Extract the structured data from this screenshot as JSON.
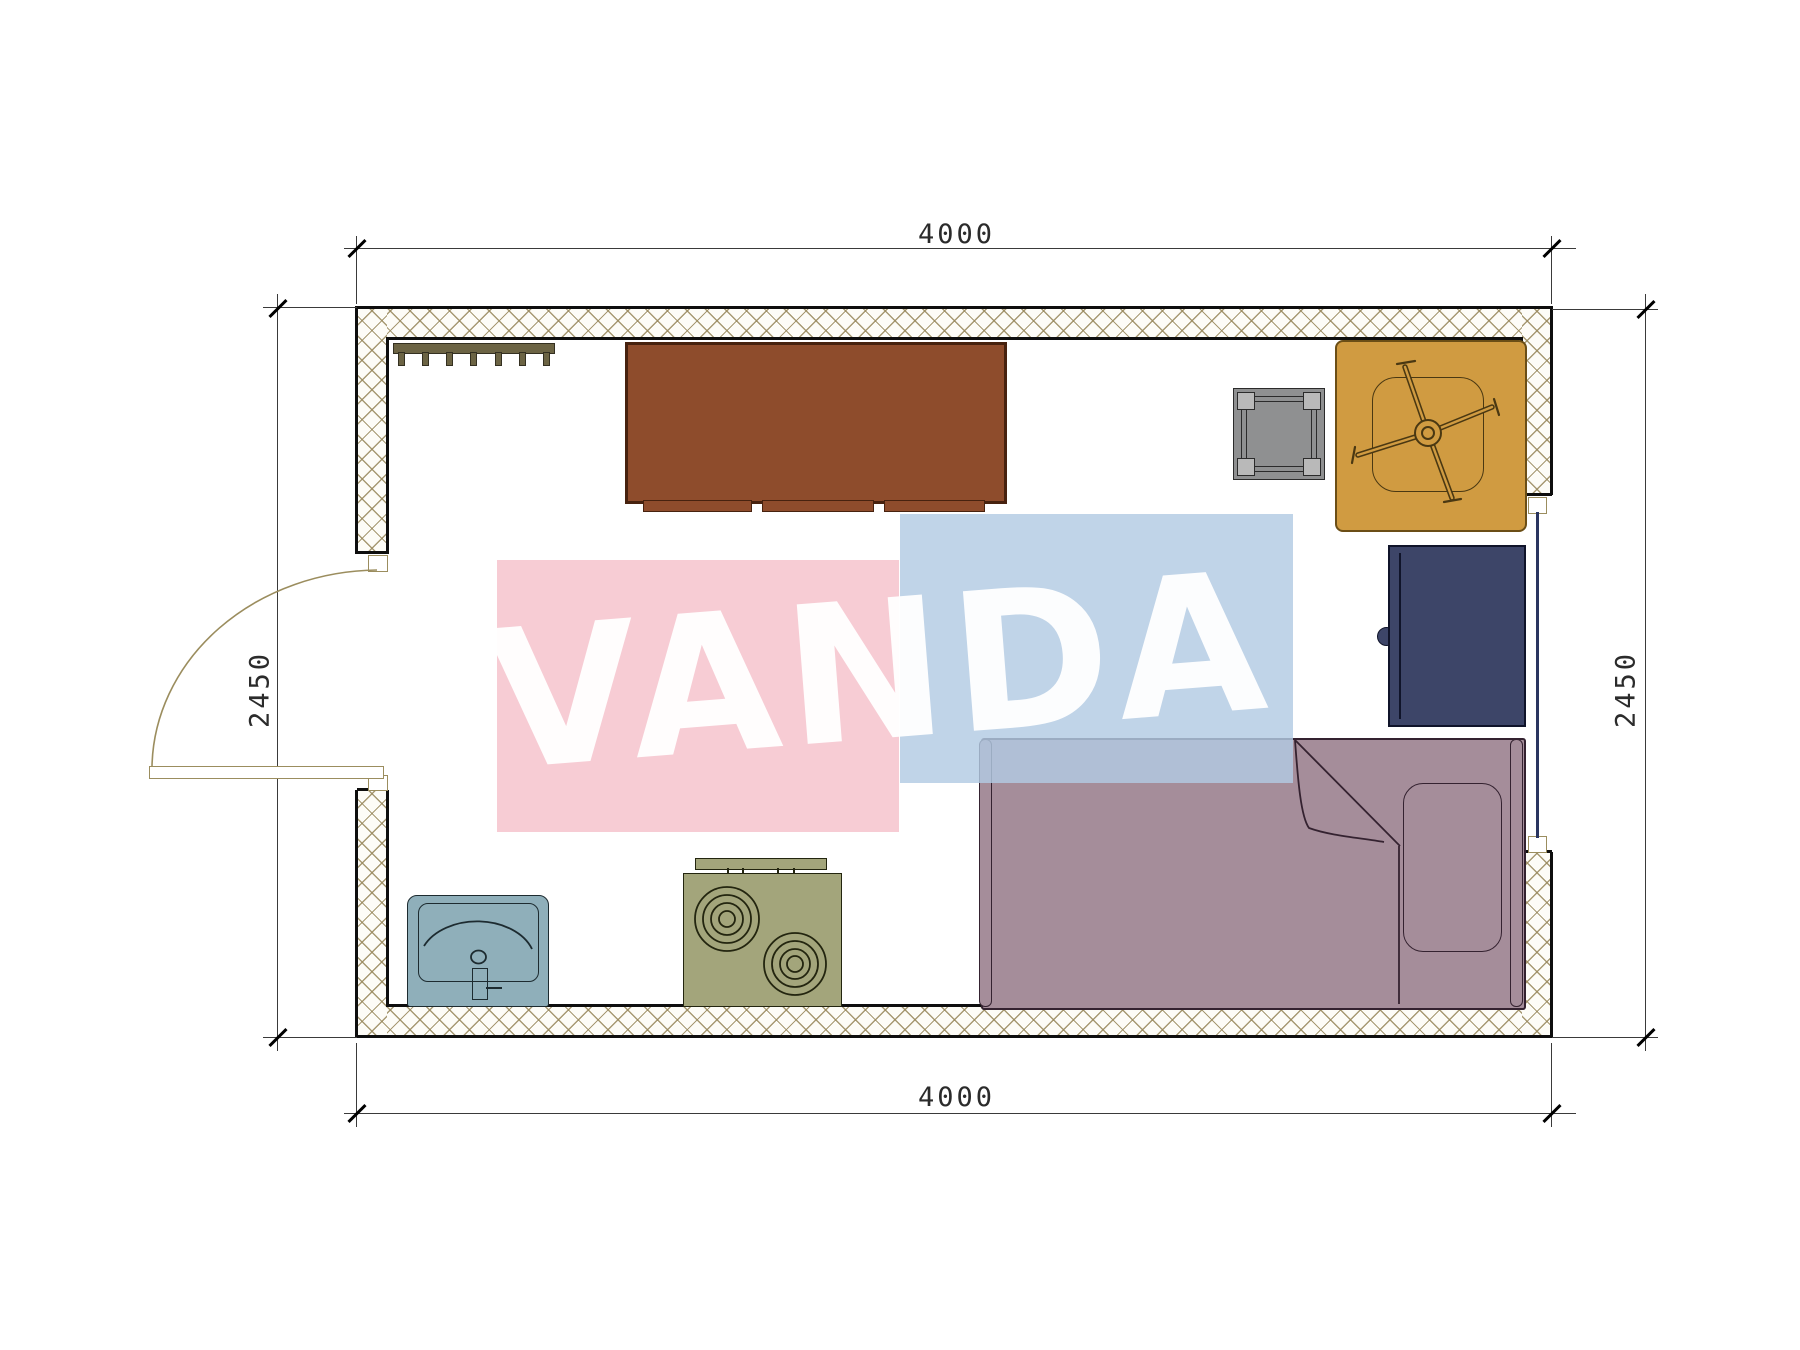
{
  "watermark": {
    "text": "VANDA"
  },
  "dimensions": {
    "top": "4000",
    "bottom": "4000",
    "left": "2450",
    "right": "2450"
  },
  "plan": {
    "type": "floor-plan",
    "room_width_mm": 4000,
    "room_depth_mm": 2450,
    "openings": [
      "door-left-wall",
      "window-right-wall"
    ],
    "furniture": [
      "coat-rack",
      "cabinet",
      "side-table",
      "armchair",
      "wardrobe",
      "single-bed",
      "stove",
      "sink"
    ]
  },
  "colors": {
    "wall-line": "#0e0e0e",
    "dim-line": "#3a3a3a",
    "arc-line": "#9b8d5e",
    "rack": "#6c6444",
    "cabinet": "#8e4c2c",
    "table": "#8f9091",
    "chair": "#d09b41",
    "wardrobe": "#3d4568",
    "bed": "#a58d9a",
    "stove": "#a3a57b",
    "sink": "#8fafba",
    "glass": "#2a3560",
    "wm-pink": "rgba(246,196,206,0.87)",
    "wm-blue": "rgba(178,202,227,0.82)",
    "wm-text": "rgba(255,255,255,0.95)"
  }
}
